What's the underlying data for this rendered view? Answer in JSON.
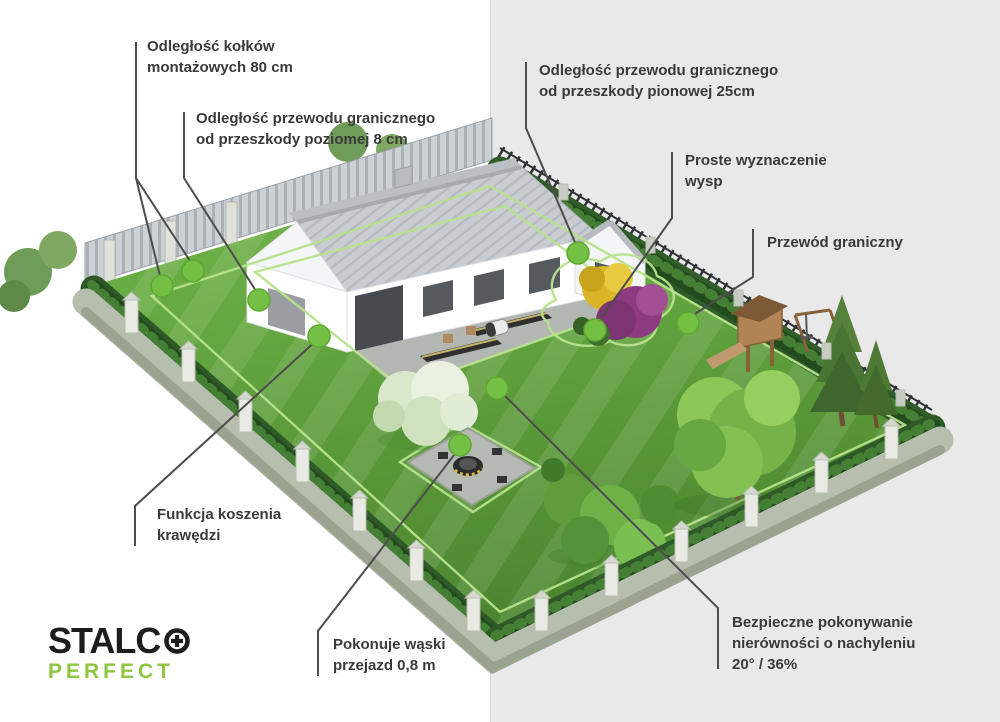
{
  "background": {
    "left_color": "#ffffff",
    "right_color": "#e9e9e9"
  },
  "style": {
    "label_text_color": "#3a3a3a",
    "callout_line_color": "#4d4d4d",
    "marker_dot_color": "#74c044",
    "lawn_color": "#5fa03c",
    "hedge_color": "#2f5a28",
    "boundary_wire_color": "#b7e38b"
  },
  "callouts": [
    {
      "id": "peg-spacing",
      "line1": "Odległość kołków",
      "line2": "montażowych 80 cm"
    },
    {
      "id": "wire-horizontal-obstacle",
      "line1": "Odległość przewodu granicznego",
      "line2": "od przeszkody poziomej 8 cm"
    },
    {
      "id": "wire-vertical-obstacle",
      "line1": "Odległość przewodu granicznego",
      "line2": "od przeszkody pionowej 25cm"
    },
    {
      "id": "island-marking",
      "line1": "Proste wyznaczenie",
      "line2": "wysp"
    },
    {
      "id": "boundary-wire",
      "line1": "Przewód graniczny"
    },
    {
      "id": "edge-mowing",
      "line1": "Funkcja koszenia",
      "line2": "krawędzi"
    },
    {
      "id": "narrow-passage",
      "line1": "Pokonuje wąski",
      "line2": "przejazd 0,8 m"
    },
    {
      "id": "slope-handling",
      "line1": "Bezpieczne pokonywanie",
      "line2": "nierówności o nachyleniu",
      "line3": "20° / 36%"
    }
  ],
  "brand": {
    "name": "STALCO",
    "display_prefix": "STALC",
    "sub": "PERFECT",
    "dark_color": "#1d1d1b",
    "green_color": "#8fc640"
  }
}
